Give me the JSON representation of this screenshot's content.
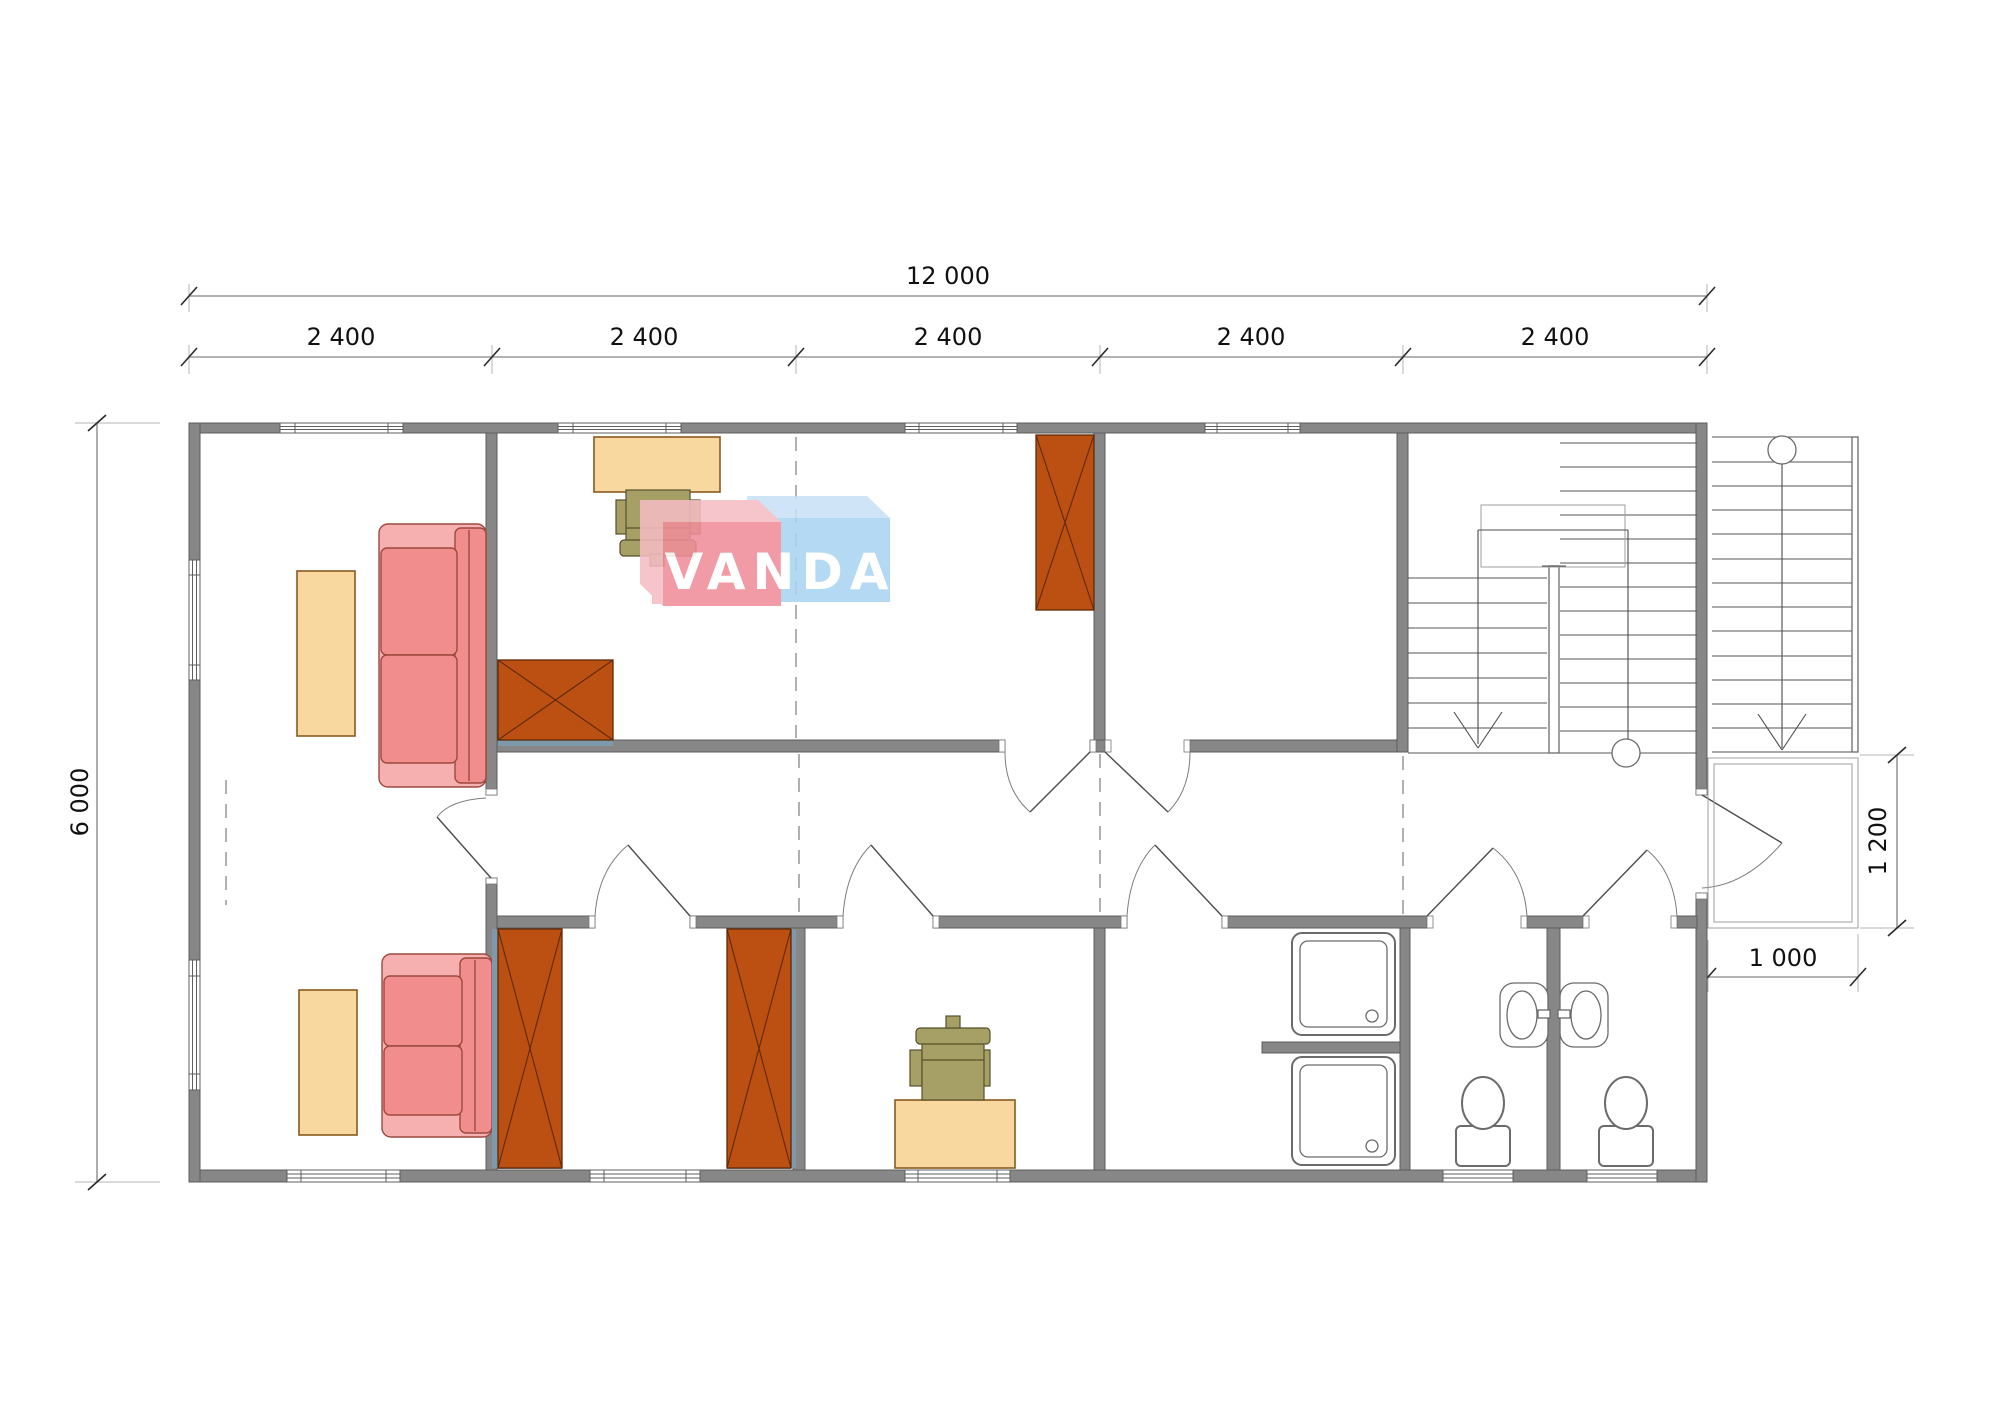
{
  "drawing": {
    "type": "architectural floor plan",
    "building_outline_mm": {
      "width": "12000",
      "depth": "6000"
    }
  },
  "dimensions": {
    "total_width": "12 000",
    "bays": [
      "2 400",
      "2 400",
      "2 400",
      "2 400",
      "2 400"
    ],
    "total_depth": "6 000",
    "porch_side": "1 200",
    "porch_front": "1 000"
  },
  "watermark": {
    "text": "VANDA"
  },
  "colors": {
    "wall": "#878787",
    "sofa": "#f18d8d",
    "sofa_frame": "#f7b0b0",
    "table": "#f9d8a0",
    "wardrobe": "#bc4f12",
    "chair": "#a7a066",
    "fixture_outline": "#6b6b6b",
    "watermark_red": "#ef8e9a",
    "watermark_blue": "#a9d4f2",
    "watermark_red_top": "#f5bcc4",
    "watermark_blue_top": "#c9e2f6"
  },
  "symbols": {
    "stair_direction": "down-arrow",
    "level_marker": "circle"
  }
}
